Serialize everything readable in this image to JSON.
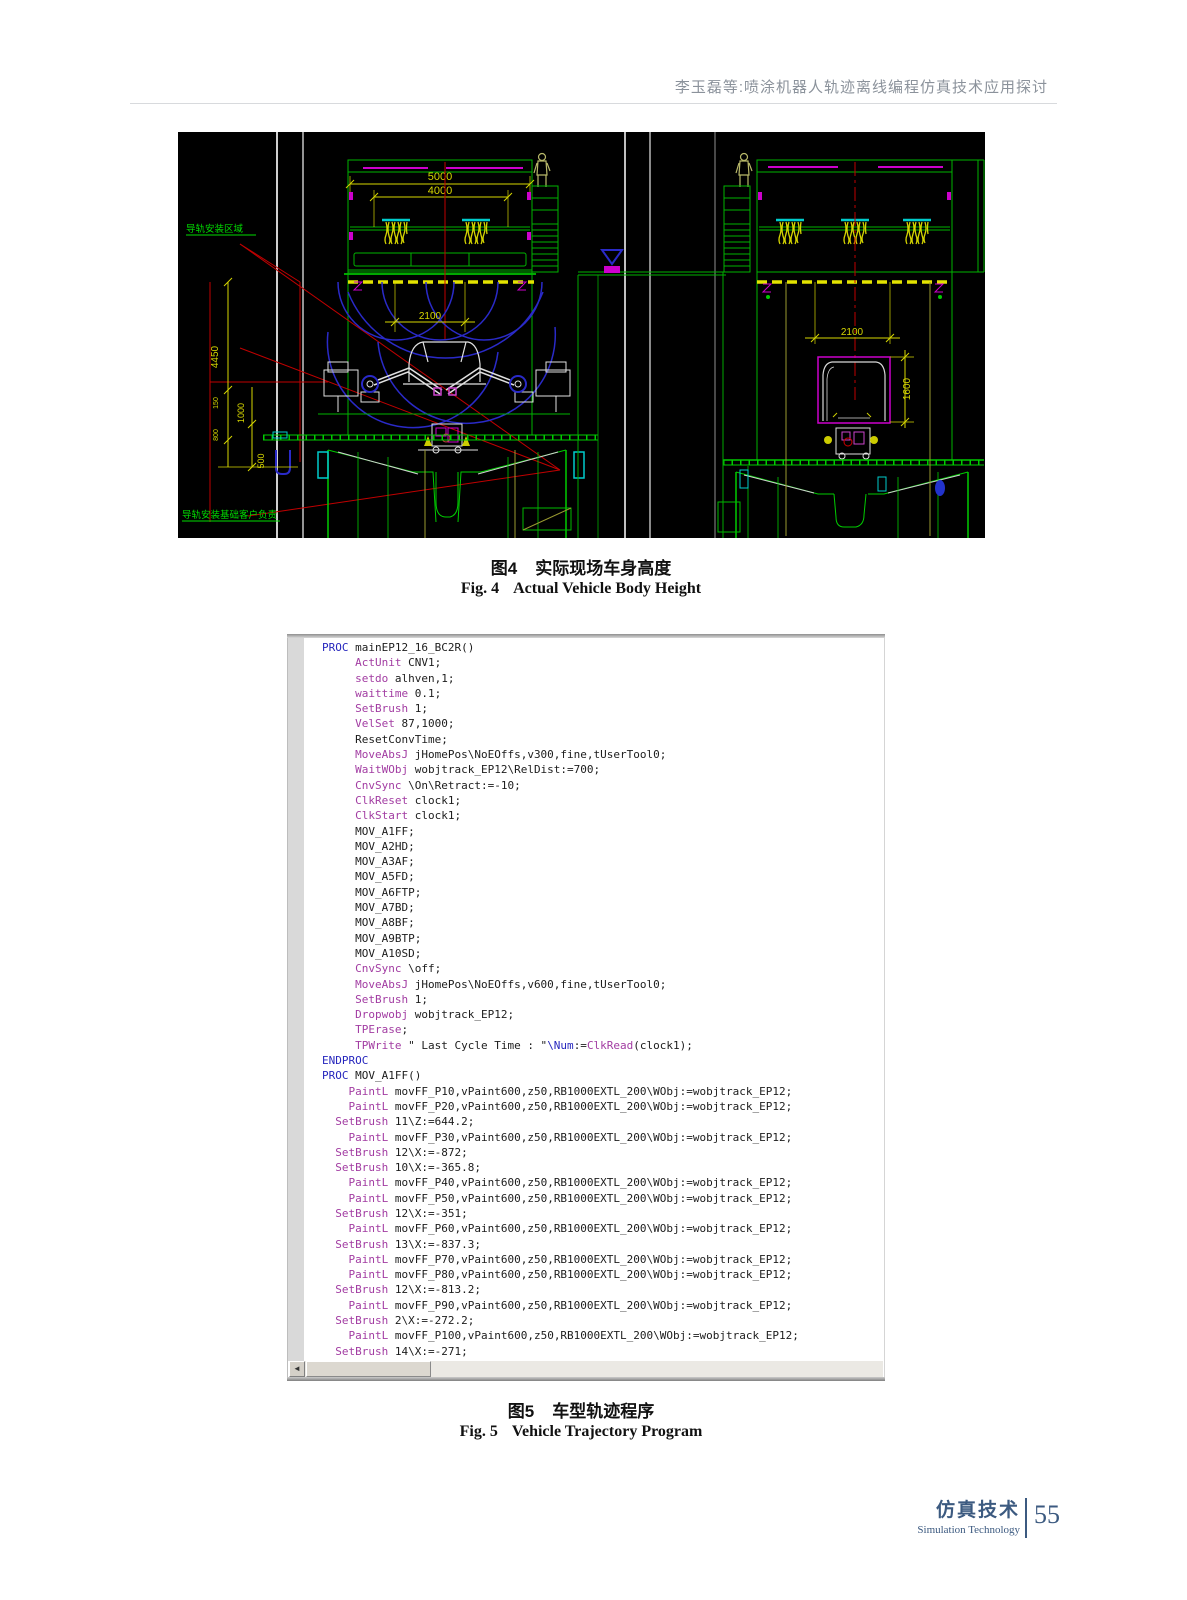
{
  "page": {
    "header": "李玉磊等:喷涂机器人轨迹离线编程仿真技术应用探讨",
    "footer": {
      "journal_cn": "仿真技术",
      "journal_en": "Simulation Technology",
      "page_number": "55"
    }
  },
  "figure4": {
    "caption_label_cn": "图4",
    "caption_text_cn": "实际现场车身高度",
    "caption_label_en": "Fig. 4",
    "caption_text_en": "Actual Vehicle Body Height",
    "cad": {
      "labels": {
        "rail_area": "导轨安装区域",
        "rail_base": "导轨安装基础客户负责"
      },
      "dims": {
        "d5000": "5000",
        "d4000": "4000",
        "d2100L": "2100",
        "d2100R": "2100",
        "d1600": "1600",
        "d4450": "4450",
        "d1000": "1000",
        "d500": "500",
        "d150": "150",
        "d800": "800"
      }
    }
  },
  "figure5": {
    "caption_label_cn": "图5",
    "caption_text_cn": "车型轨迹程序",
    "caption_label_en": "Fig. 5",
    "caption_text_en": "Vehicle Trajectory Program",
    "scrollbar": {
      "left_arrow": "◄"
    },
    "code": {
      "tokens": {
        "blue": [
          "PROC",
          "ENDPROC"
        ],
        "purple": [
          "ActUnit",
          "setdo",
          "waittime",
          "SetBrush",
          "VelSet",
          "MoveAbsJ",
          "WaitWObj",
          "CnvSync",
          "ClkReset",
          "ClkStart",
          "PaintL",
          "Dropwobj",
          "TPErase",
          "TPWrite",
          "ClkRead"
        ],
        "blue_literals": [
          "\\Num"
        ]
      },
      "lines": [
        "PROC mainEP12_16_BC2R()",
        "     ActUnit CNV1;",
        "     setdo alhven,1;",
        "     waittime 0.1;",
        "     SetBrush 1;",
        "     VelSet 87,1000;",
        "     ResetConvTime;",
        "     MoveAbsJ jHomePos\\NoEOffs,v300,fine,tUserTool0;",
        "     WaitWObj wobjtrack_EP12\\RelDist:=700;",
        "     CnvSync \\On\\Retract:=-10;",
        "     ClkReset clock1;",
        "     ClkStart clock1;",
        "     MOV_A1FF;",
        "     MOV_A2HD;",
        "     MOV_A3AF;",
        "     MOV_A5FD;",
        "     MOV_A6FTP;",
        "     MOV_A7BD;",
        "     MOV_A8BF;",
        "     MOV_A9BTP;",
        "     MOV_A10SD;",
        "     CnvSync \\off;",
        "     MoveAbsJ jHomePos\\NoEOffs,v600,fine,tUserTool0;",
        "     SetBrush 1;",
        "     Dropwobj wobjtrack_EP12;",
        "     TPErase;",
        "     TPWrite \" Last Cycle Time : \"\\Num:=ClkRead(clock1);",
        "ENDPROC",
        "PROC MOV_A1FF()",
        "    PaintL movFF_P10,vPaint600,z50,RB1000EXTL_200\\WObj:=wobjtrack_EP12;",
        "    PaintL movFF_P20,vPaint600,z50,RB1000EXTL_200\\WObj:=wobjtrack_EP12;",
        "  SetBrush 11\\Z:=644.2;",
        "    PaintL movFF_P30,vPaint600,z50,RB1000EXTL_200\\WObj:=wobjtrack_EP12;",
        "  SetBrush 12\\X:=-872;",
        "  SetBrush 10\\X:=-365.8;",
        "    PaintL movFF_P40,vPaint600,z50,RB1000EXTL_200\\WObj:=wobjtrack_EP12;",
        "    PaintL movFF_P50,vPaint600,z50,RB1000EXTL_200\\WObj:=wobjtrack_EP12;",
        "  SetBrush 12\\X:=-351;",
        "    PaintL movFF_P60,vPaint600,z50,RB1000EXTL_200\\WObj:=wobjtrack_EP12;",
        "  SetBrush 13\\X:=-837.3;",
        "    PaintL movFF_P70,vPaint600,z50,RB1000EXTL_200\\WObj:=wobjtrack_EP12;",
        "    PaintL movFF_P80,vPaint600,z50,RB1000EXTL_200\\WObj:=wobjtrack_EP12;",
        "  SetBrush 12\\X:=-813.2;",
        "    PaintL movFF_P90,vPaint600,z50,RB1000EXTL_200\\WObj:=wobjtrack_EP12;",
        "  SetBrush 2\\X:=-272.2;",
        "    PaintL movFF_P100,vPaint600,z50,RB1000EXTL_200\\WObj:=wobjtrack_EP12;",
        "  SetBrush 14\\X:=-271;",
        "    PaintL movFF_P110,vPaint600,z50,RB1000EXTL_200\\WObj:=wobjtrack_EP12;"
      ]
    }
  }
}
